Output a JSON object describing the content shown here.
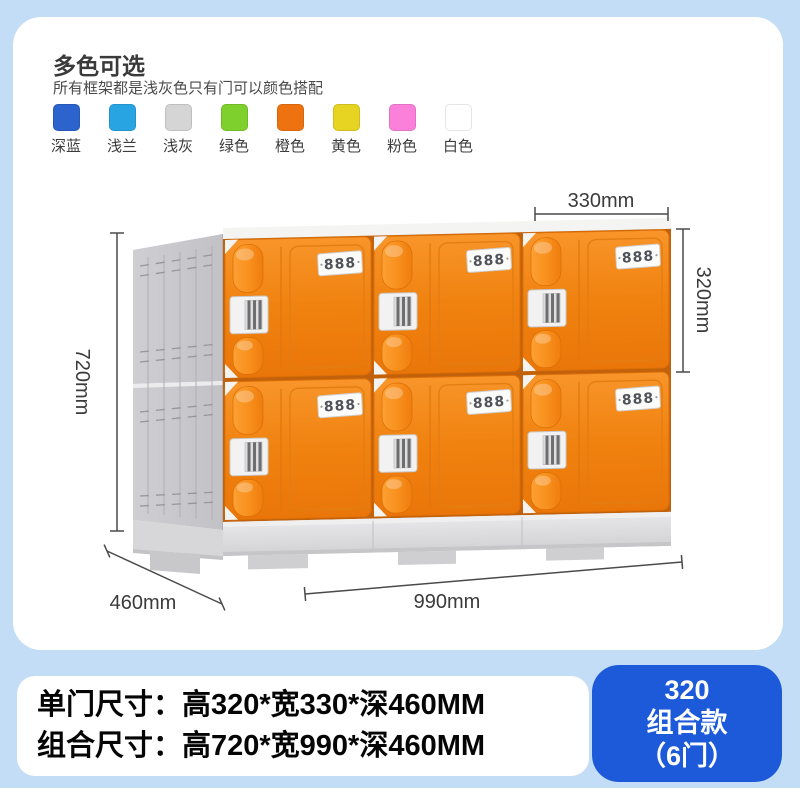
{
  "colors_section": {
    "title": "多色可选",
    "subtitle": "所有框架都是浅灰色只有门可以颜色搭配",
    "swatches": [
      {
        "label": "深蓝",
        "color": "#2c63cd"
      },
      {
        "label": "浅兰",
        "color": "#29a4e2"
      },
      {
        "label": "浅灰",
        "color": "#d5d5d5"
      },
      {
        "label": "绿色",
        "color": "#7ed02c"
      },
      {
        "label": "橙色",
        "color": "#ee7310"
      },
      {
        "label": "黄色",
        "color": "#e7d321"
      },
      {
        "label": "粉色",
        "color": "#fb80d9"
      },
      {
        "label": "白色",
        "color": "#ffffff"
      }
    ]
  },
  "diagram": {
    "plate_label": "888",
    "door_color": "#f0830f",
    "frame_color": "#c6c6ca",
    "dimensions": {
      "door_width": "330mm",
      "door_height": "320mm",
      "total_height": "720mm",
      "depth": "460mm",
      "total_width": "990mm"
    }
  },
  "specs": {
    "single_door": "单门尺寸：高320*宽330*深460MM",
    "combined": "组合尺寸：高720*宽990*深460MM"
  },
  "badge": {
    "model": "320",
    "type": "组合款",
    "doors": "（6门）",
    "background": "#1d5ada"
  }
}
